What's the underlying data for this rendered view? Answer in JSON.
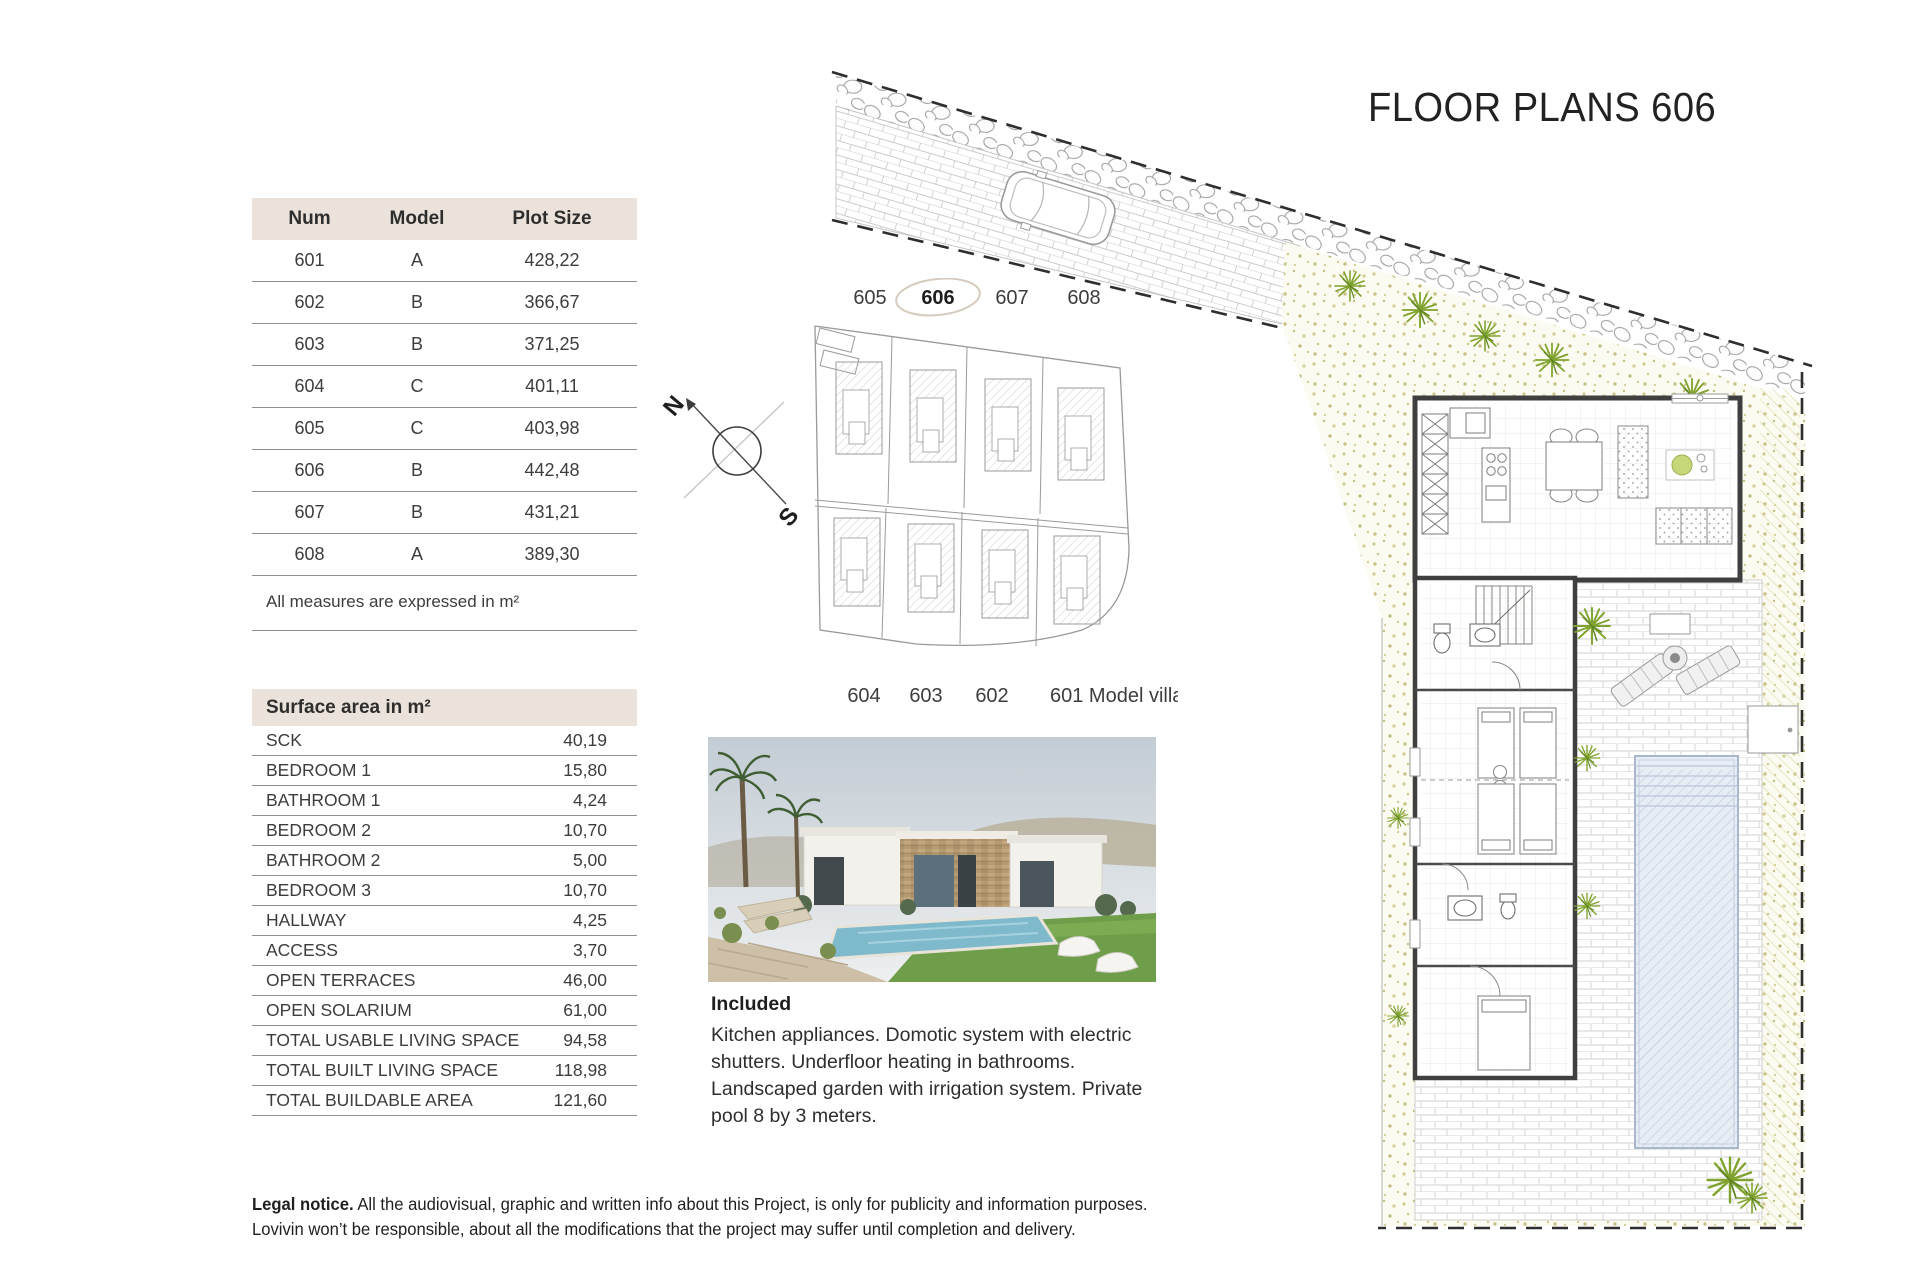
{
  "title": "FLOOR PLANS 606",
  "plots_table": {
    "headers": {
      "num": "Num",
      "model": "Model",
      "size": "Plot Size"
    },
    "rows": [
      {
        "num": "601",
        "model": "A",
        "size": "428,22"
      },
      {
        "num": "602",
        "model": "B",
        "size": "366,67"
      },
      {
        "num": "603",
        "model": "B",
        "size": "371,25"
      },
      {
        "num": "604",
        "model": "C",
        "size": "401,11"
      },
      {
        "num": "605",
        "model": "C",
        "size": "403,98"
      },
      {
        "num": "606",
        "model": "B",
        "size": "442,48"
      },
      {
        "num": "607",
        "model": "B",
        "size": "431,21"
      },
      {
        "num": "608",
        "model": "A",
        "size": "389,30"
      }
    ],
    "note": "All measures are expressed in m²"
  },
  "surface_table": {
    "title": "Surface area in m²",
    "rows": [
      {
        "label": "SCK",
        "value": "40,19"
      },
      {
        "label": "BEDROOM 1",
        "value": "15,80"
      },
      {
        "label": "BATHROOM 1",
        "value": "4,24"
      },
      {
        "label": "BEDROOM 2",
        "value": "10,70"
      },
      {
        "label": "BATHROOM 2",
        "value": "5,00"
      },
      {
        "label": "BEDROOM 3",
        "value": "10,70"
      },
      {
        "label": "HALLWAY",
        "value": "4,25"
      },
      {
        "label": "ACCESS",
        "value": "3,70"
      },
      {
        "label": "OPEN TERRACES",
        "value": "46,00"
      },
      {
        "label": "OPEN SOLARIUM",
        "value": "61,00"
      },
      {
        "label": "TOTAL USABLE LIVING SPACE",
        "value": "94,58"
      },
      {
        "label": "TOTAL BUILT LIVING SPACE",
        "value": "118,98"
      },
      {
        "label": "TOTAL BUILDABLE AREA",
        "value": "121,60"
      }
    ]
  },
  "site_map": {
    "top_labels": [
      "605",
      "606",
      "607",
      "608"
    ],
    "highlighted_plot": "606",
    "bottom_labels": [
      "604",
      "603",
      "602"
    ],
    "model_villa_label": "601 Model villa"
  },
  "compass": {
    "north": "N",
    "south": "S"
  },
  "included": {
    "heading": "Included",
    "body": "Kitchen appliances. Domotic system with electric shutters. Underfloor heating in bathrooms. Landscaped garden with irrigation system. Private pool 8 by 3 meters."
  },
  "legal": {
    "heading": "Legal notice.",
    "body": " All the audiovisual, graphic and written info about this Project, is only for publicity and information purposes. Lovivin won’t be responsible, about all the modifications that the project may suffer until completion and delivery."
  },
  "colors": {
    "table_header_bg": "#ebe3db",
    "rule": "#8f8f8f",
    "text": "#3d3d3d",
    "plant_green": "#7fa32e",
    "pool_blue": "#e7edf5"
  }
}
